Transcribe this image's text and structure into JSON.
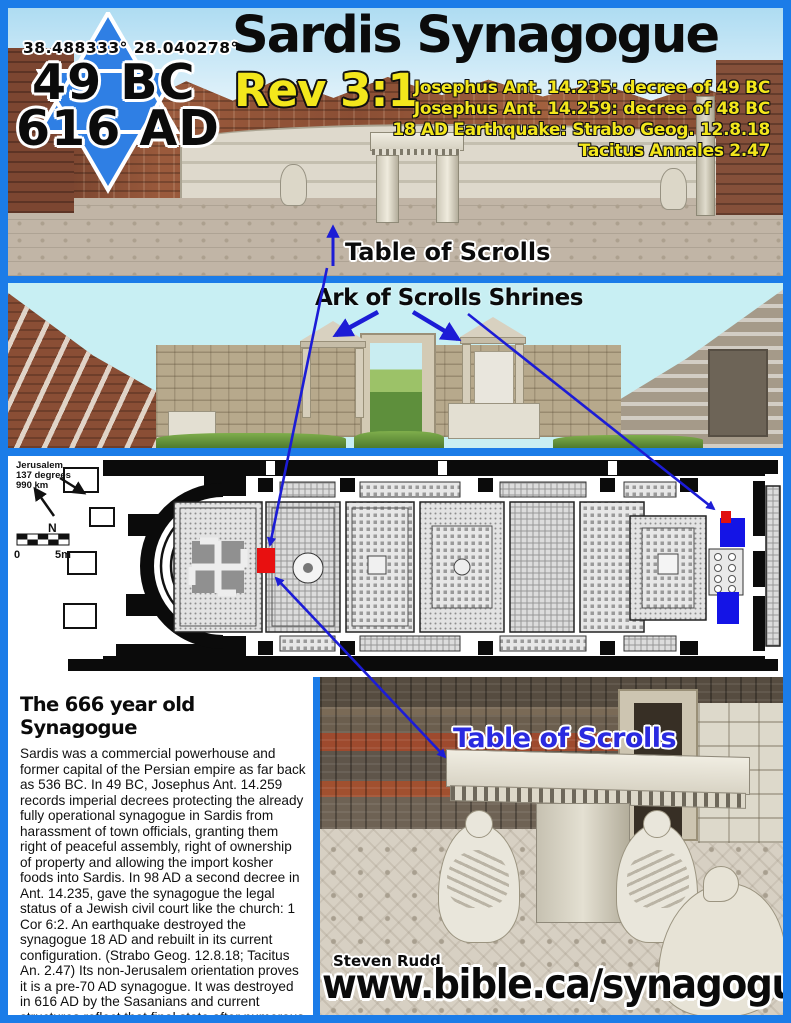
{
  "poster": {
    "frame_color": "#1b7ce8",
    "accent_yellow": "#f3e71c",
    "label_blue": "#2a2ae0",
    "header": {
      "coordinates": "38.488333°  28.040278°",
      "year_founded": "49 BC",
      "year_destroyed": "616 AD",
      "title": "Sardis Synagogue",
      "verse": "Rev 3:1",
      "citations": [
        "Josephus Ant. 14.235: decree of 49 BC",
        "Josephus Ant. 14.259: decree of 48 BC",
        "18 AD Earthquake: Strabo Geog. 12.8.18",
        "Tacitus Annales 2.47"
      ]
    },
    "photo_top": {
      "caption": "Table of Scrolls"
    },
    "photo_shrines": {
      "caption": "Ark of Scrolls Shrines"
    },
    "floor_plan": {
      "compass_note_lines": [
        "Jerusalem",
        "137 degrees",
        "990 km"
      ],
      "north_label": "N",
      "scale_zero": "0",
      "scale_five": "5m",
      "table_marker_color": "#e81010",
      "shrine_marker_color": "#1414e6"
    },
    "article": {
      "title": "The 666 year old Synagogue",
      "body": "Sardis was a commercial powerhouse and former capital of the Persian empire as far back as 536 BC. In 49 BC, Josephus Ant. 14.259 records imperial decrees protecting the already fully operational synagogue in Sardis from harassment of town officials, granting them right of peaceful assembly, right of ownership of property and allowing the import kosher foods into Sardis. In 98 AD a second decree in Ant. 14.235, gave the synagogue the legal status of a Jewish civil court like the church: 1 Cor 6:2. An earthquake destroyed the synagogue 18 AD and rebuilt in its current configuration. (Strabo Geog. 12.8.18; Tacitus An. 2.47) Its non-Jerusalem orientation proves it is a pre-70 AD synagogue. It was destroyed in 616 AD by the Sasanians and current structures reflect that final state after numerous renovations over 666 years."
    },
    "photo_table": {
      "caption": "Table of Scrolls"
    },
    "footer": {
      "credit": "Steven Rudd",
      "website": "www.bible.ca/synagogues"
    }
  }
}
